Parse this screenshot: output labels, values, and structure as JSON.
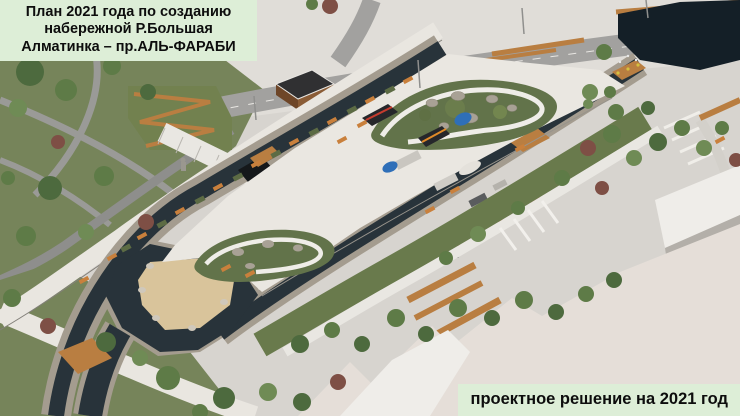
{
  "labels": {
    "plan": {
      "lines": [
        "План 2021 года по созданию",
        "набережной Р.Большая",
        "Алматинка – пр.АЛЬ-ФАРАБИ"
      ]
    },
    "solution": {
      "text": "проектное решение на 2021 год"
    }
  },
  "palette": {
    "label_bg": "#ddeed7",
    "label_text": "#0d0d0d",
    "water": "#28333a",
    "pond_water": "#141f27",
    "sand": "#d9c49b",
    "island_plaza": "#eae7e1",
    "promenade": "#e9e6e0",
    "plaza_base": "#d7d4cf",
    "road": "#9e9d9b",
    "asphalt": "#8e8e8c",
    "park_green": "#76845a",
    "lawn": "#697a4c",
    "garden_green": "#62734a",
    "wood": "#b97e41",
    "bench_orange": "#c9803c",
    "stone_wall": "#a49c8f",
    "roof_beige": "#e5ded8",
    "roof_white": "#efede9",
    "roof_gray": "#b3afa9",
    "canopy_red": "#c63b2e",
    "canopy_blue": "#2f6fb8",
    "canopy_orange": "#e08a28",
    "canopy_dark": "#26272b"
  }
}
